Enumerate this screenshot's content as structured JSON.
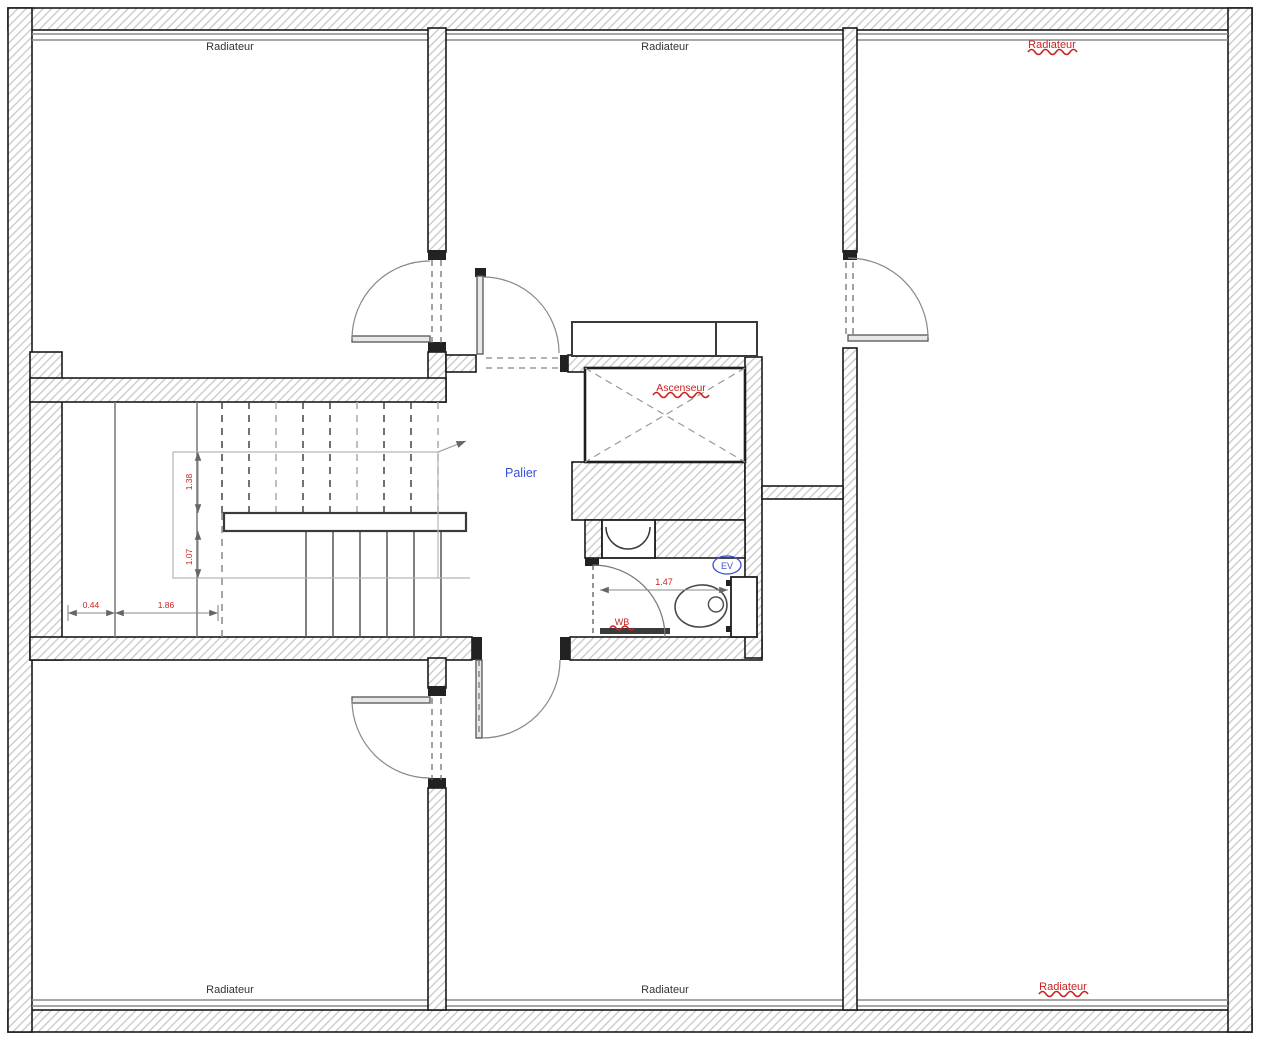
{
  "plan": {
    "labels": {
      "radiator_top_left": "Radiateur",
      "radiator_top_center": "Radiateur",
      "radiator_top_right": "Radiateur",
      "radiator_bottom_left": "Radiateur",
      "radiator_bottom_center": "Radiateur",
      "radiator_bottom_right": "Radiateur",
      "elevator": "Ascenseur",
      "landing": "Palier",
      "wc_mark": "WB",
      "sink_mark": "EV"
    },
    "dimensions": {
      "stair_run_small": "0.44",
      "stair_run_large": "1.86",
      "stair_rise_top": "1.38",
      "stair_rise_bottom": "1.07",
      "wc_width": "1.47"
    },
    "colors": {
      "annotation_red": "#c92222",
      "annotation_blue": "#3a4fd6",
      "label_black": "#333333",
      "wall_stroke": "#1a1a1a",
      "hatch_gray": "#c8c8c8"
    }
  }
}
